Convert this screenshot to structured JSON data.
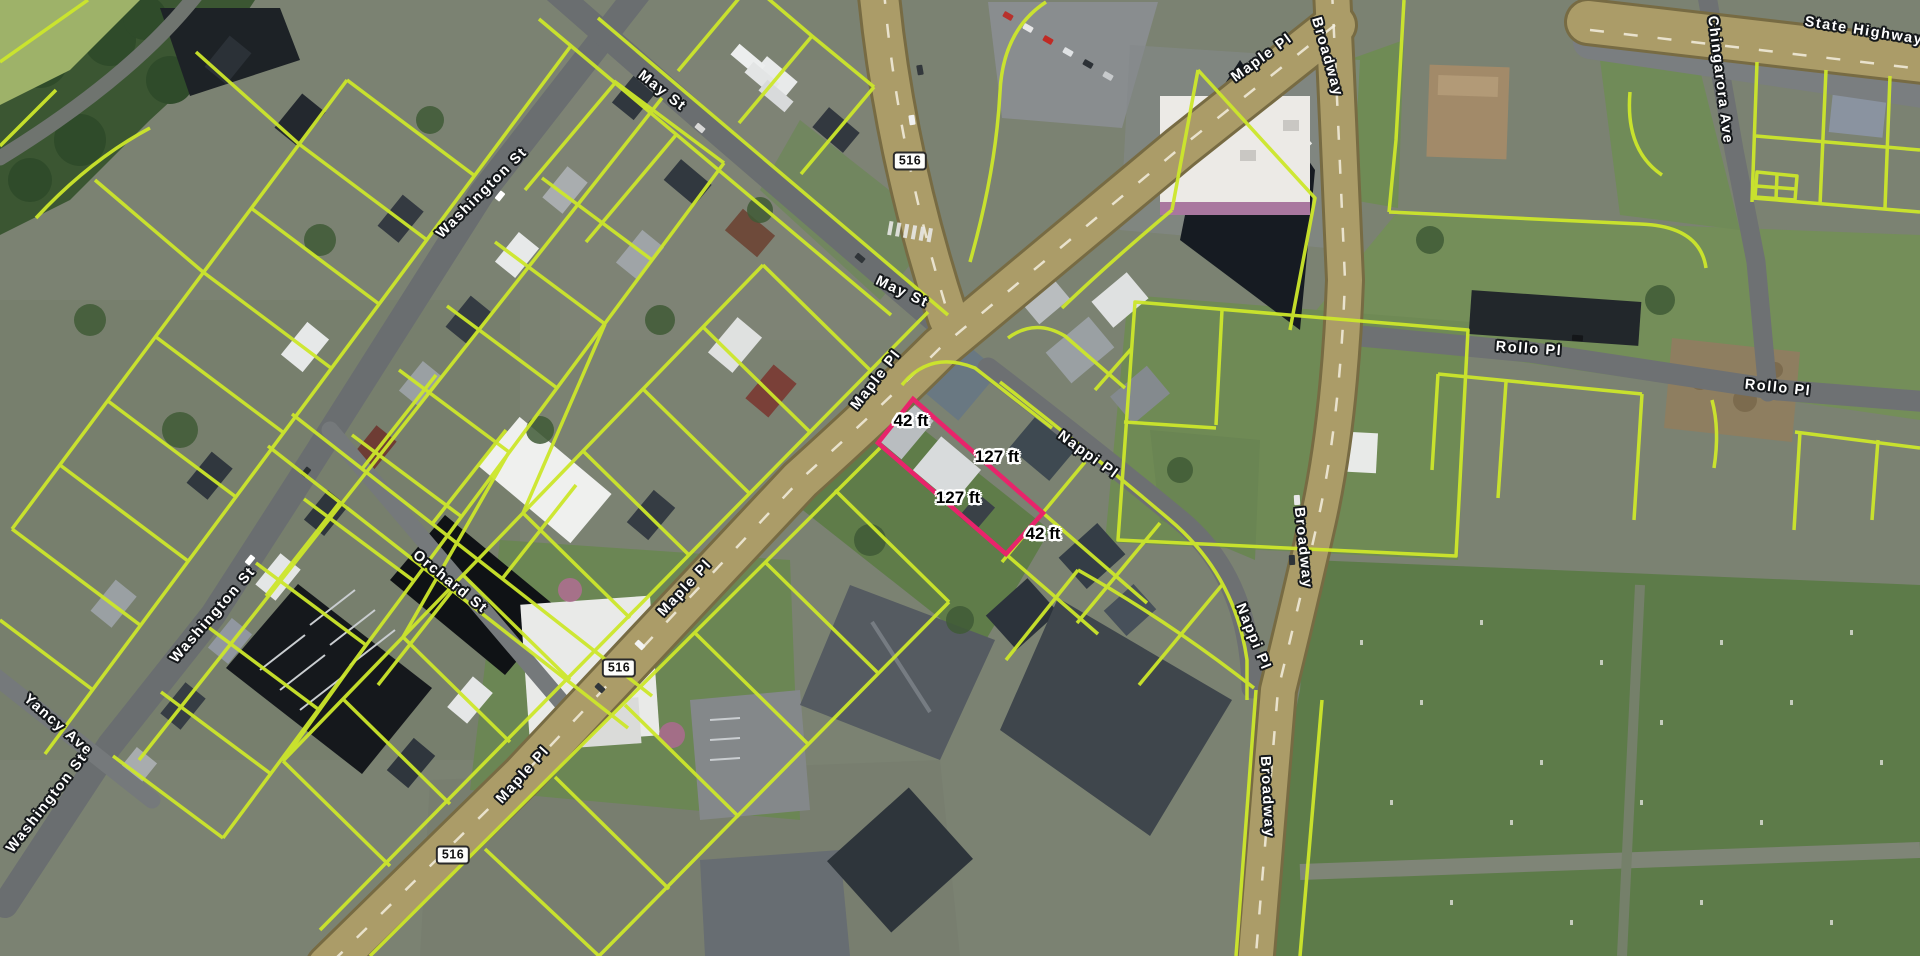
{
  "app": {
    "view": "aerial-parcel-map"
  },
  "overlay": {
    "parcel_line_color": "#cde72b",
    "selected_parcel_color": "#e8246b"
  },
  "selected_parcel": {
    "points_str": "913,399 1043,513 1006,554 878,443",
    "frontage": "42 ft",
    "depth": "127 ft"
  },
  "labels": {
    "streets": [
      {
        "text": "May St",
        "x": 662,
        "y": 91,
        "rot": 38
      },
      {
        "text": "May St",
        "x": 902,
        "y": 292,
        "rot": 25
      },
      {
        "text": "Washington St",
        "x": 482,
        "y": 193,
        "rot": -45
      },
      {
        "text": "Washington St",
        "x": 213,
        "y": 615,
        "rot": -49
      },
      {
        "text": "Washington St",
        "x": 47,
        "y": 803,
        "rot": -52
      },
      {
        "text": "Yancy Ave",
        "x": 58,
        "y": 725,
        "rot": 41
      },
      {
        "text": "Orchard St",
        "x": 450,
        "y": 582,
        "rot": 39
      },
      {
        "text": "Maple Pl",
        "x": 876,
        "y": 380,
        "rot": -52
      },
      {
        "text": "Maple Pl",
        "x": 685,
        "y": 588,
        "rot": -47
      },
      {
        "text": "Maple Pl",
        "x": 523,
        "y": 775,
        "rot": -48
      },
      {
        "text": "Maple Pl",
        "x": 1262,
        "y": 58,
        "rot": -36
      },
      {
        "text": "Broadway",
        "x": 1327,
        "y": 57,
        "rot": 74
      },
      {
        "text": "Broadway",
        "x": 1303,
        "y": 548,
        "rot": 84
      },
      {
        "text": "Broadway",
        "x": 1267,
        "y": 797,
        "rot": 87
      },
      {
        "text": "Nappi Pl",
        "x": 1088,
        "y": 455,
        "rot": 36
      },
      {
        "text": "Nappi Pl",
        "x": 1253,
        "y": 637,
        "rot": 68
      },
      {
        "text": "Rollo Pl",
        "x": 1529,
        "y": 349,
        "rot": 4
      },
      {
        "text": "Rollo Pl",
        "x": 1778,
        "y": 388,
        "rot": 6
      },
      {
        "text": "Chingarora Ave",
        "x": 1720,
        "y": 80,
        "rot": 83
      },
      {
        "text": "State Highway",
        "x": 1864,
        "y": 31,
        "rot": 9
      }
    ],
    "shields": [
      {
        "text": "516",
        "x": 910,
        "y": 161,
        "rot": 0
      },
      {
        "text": "516",
        "x": 619,
        "y": 668,
        "rot": 0
      },
      {
        "text": "516",
        "x": 453,
        "y": 855,
        "rot": 0
      }
    ],
    "dimensions": [
      {
        "text": "42 ft",
        "x": 911,
        "y": 421,
        "rot": 0
      },
      {
        "text": "127 ft",
        "x": 997,
        "y": 457,
        "rot": 0
      },
      {
        "text": "127 ft",
        "x": 958,
        "y": 498,
        "rot": 0
      },
      {
        "text": "42 ft",
        "x": 1043,
        "y": 534,
        "rot": 0
      }
    ]
  }
}
